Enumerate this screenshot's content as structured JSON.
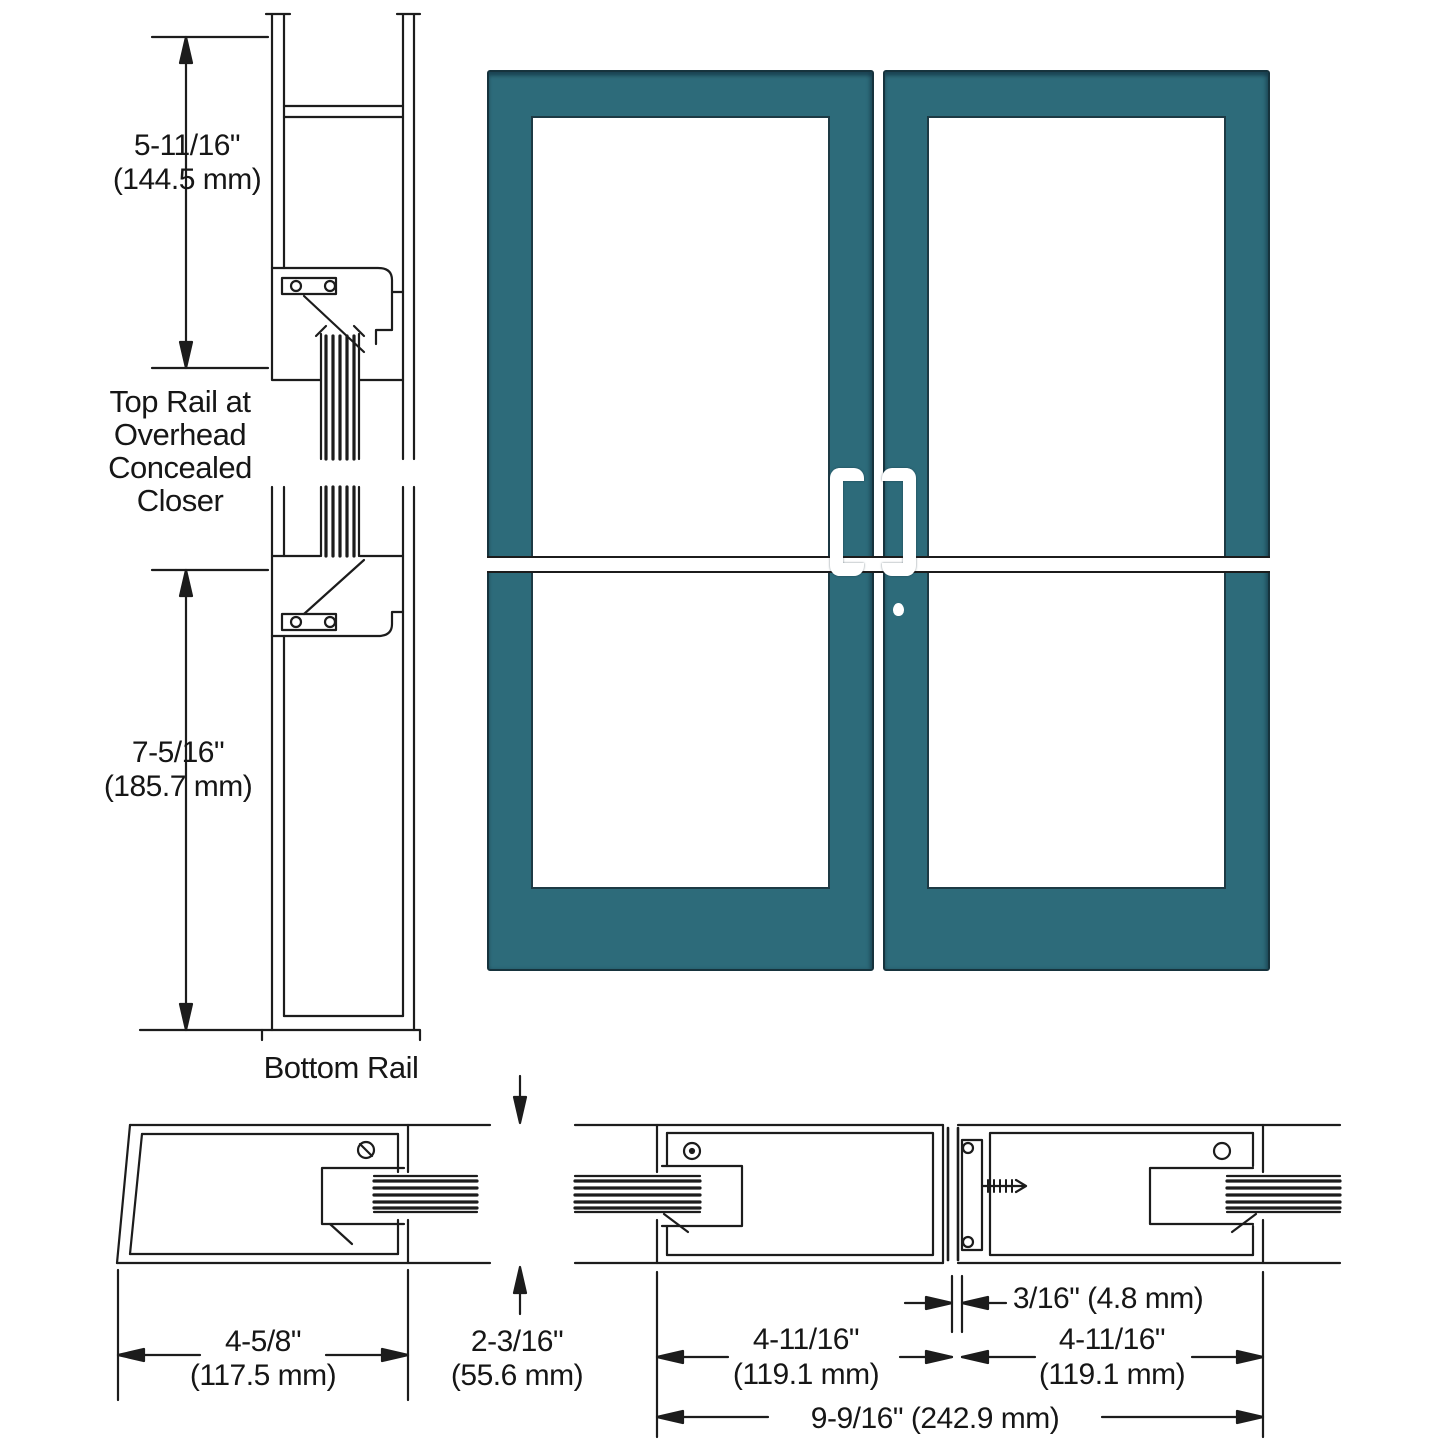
{
  "colors": {
    "door_frame_teal": "#2d6b7a",
    "line_black": "#1c1c1c",
    "handle_white": "#ffffff",
    "glass_white": "#ffffff"
  },
  "vertical_section": {
    "dim_top": {
      "inches": "5-11/16\"",
      "mm": "(144.5 mm)"
    },
    "label_top": [
      "Top Rail at",
      "Overhead",
      "Concealed",
      "Closer"
    ],
    "dim_bottom": {
      "inches": "7-5/16\"",
      "mm": "(185.7 mm)"
    },
    "label_bottom": "Bottom Rail"
  },
  "bottom_sections": {
    "dim_hinge_stile": {
      "inches": "4-5/8\"",
      "mm": "(117.5 mm)"
    },
    "dim_rail_height": {
      "inches": "2-3/16\"",
      "mm": "(55.6 mm)"
    },
    "dim_left_leaf": {
      "inches": "4-11/16\"",
      "mm": "(119.1 mm)"
    },
    "dim_gap": "3/16\" (4.8 mm)",
    "dim_right_leaf": {
      "inches": "4-11/16\"",
      "mm": "(119.1 mm)"
    },
    "dim_total": "9-9/16\" (242.9 mm)"
  }
}
